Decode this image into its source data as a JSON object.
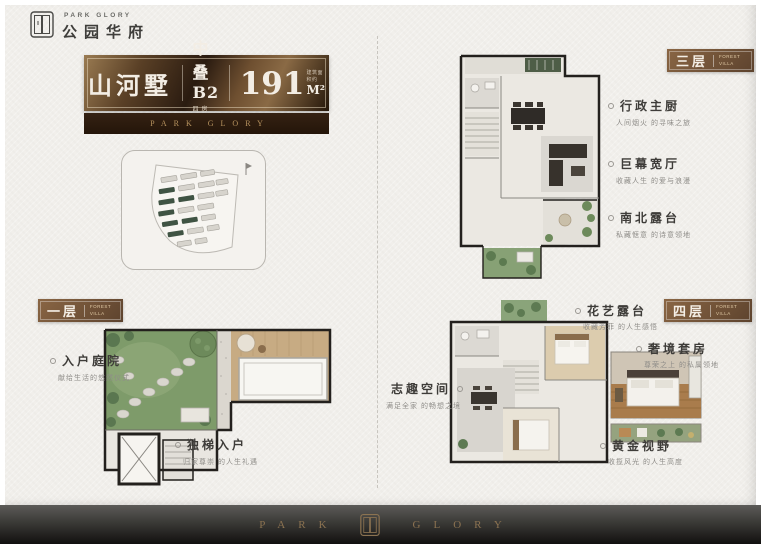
{
  "brand": {
    "logo_en": "PARK GLORY",
    "logo_cn": "公园华府"
  },
  "title_block": {
    "name": "山河墅",
    "type": "中叠B2",
    "type_sub": "四房三厅三卫",
    "area_num": "191",
    "area_unit": "M²",
    "area_note": "建筑面积约",
    "strip_en": "PARK GLORY"
  },
  "floors": {
    "first": {
      "label": "一层",
      "label_en": "FOREST VILLA",
      "annotations": [
        {
          "title": "入户庭院",
          "desc": "献给生活的悠然仪式"
        },
        {
          "title": "独梯入户",
          "desc": "归家尊崇 的人生礼遇"
        }
      ]
    },
    "third": {
      "label": "三层",
      "label_en": "FOREST VILLA",
      "annotations": [
        {
          "title": "行政主厨",
          "desc": "人间烟火 的寻味之旅"
        },
        {
          "title": "巨幕宽厅",
          "desc": "收藏人生 的爱与浪漫"
        },
        {
          "title": "南北露台",
          "desc": "私藏惬意 的诗意领地"
        }
      ]
    },
    "fourth": {
      "label": "四层",
      "label_en": "FOREST VILLA",
      "annotations": [
        {
          "title": "花艺露台",
          "desc": "收藏芳菲 的人生感悟"
        },
        {
          "title": "志趣空间",
          "desc": "满足全家 的畅想之境"
        },
        {
          "title": "奢境套房",
          "desc": "尊荣之上 的私属领地"
        },
        {
          "title": "黄金视野",
          "desc": "收揽风光 的人生高度"
        }
      ]
    }
  },
  "footer": {
    "left": "PARK",
    "right": "GLORY"
  },
  "colors": {
    "bronze": "#8c7351",
    "brown": "#6b4e33",
    "paper": "#f1efeb",
    "ink": "#3e3c39",
    "green": "#52633f"
  }
}
